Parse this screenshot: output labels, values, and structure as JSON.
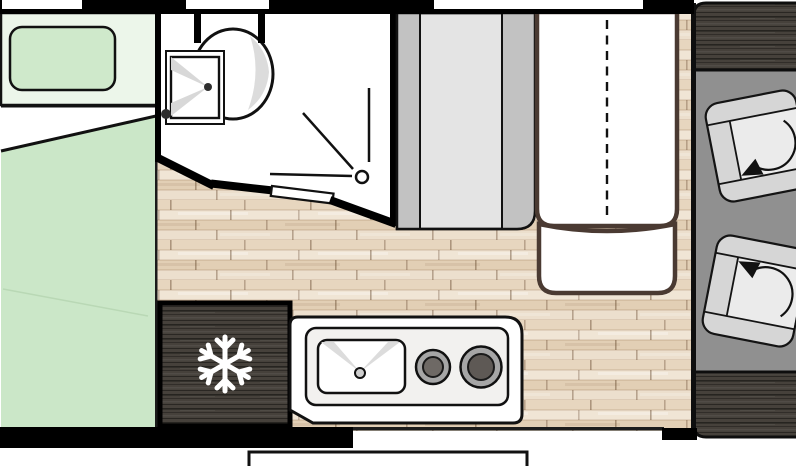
{
  "diagram": {
    "type": "motorhome-floor-plan",
    "orientation": "cab-on-right",
    "palette": {
      "wall": "#000000",
      "outside": "#ffffff",
      "wood_floor": "#ebddca",
      "cab_floor": "#909090",
      "dark_wood_furniture": "#46413b",
      "bed_green": "#cbe7c8",
      "bed_head_green": "#ecf6ea",
      "pillow_green": "#cfe9cb",
      "table_border_brown": "#4a3a32",
      "seat_gray": "#dcdcdc",
      "bench_stripe_light": "#e4e4e4",
      "bench_stripe_dark": "#c2c2c2",
      "burner_ring": "#a6a6a6",
      "burner_center_small": "#6e6965",
      "burner_center_large": "#5e5955",
      "bathroom_floor": "#ffffff"
    },
    "rooms": [
      {
        "name": "rear-bed-area",
        "furniture": [
          "double-bed",
          "bed-headboard",
          "pillow"
        ]
      },
      {
        "name": "bathroom",
        "furniture": [
          "toilet",
          "shower-tray",
          "sliding-door"
        ]
      },
      {
        "name": "dinette",
        "furniture": [
          "striped-bench-seat",
          "table-with-fold-line",
          "side-seat"
        ]
      },
      {
        "name": "kitchen",
        "furniture": [
          "refrigerator",
          "countertop",
          "sink",
          "two-burner-hob"
        ]
      },
      {
        "name": "cab",
        "furniture": [
          "cab-top-panel",
          "driver-swivel-seat",
          "passenger-swivel-seat",
          "cab-bottom-panel"
        ]
      }
    ],
    "icons": [
      {
        "name": "snowflake-icon",
        "meaning": "refrigerator-freezer"
      },
      {
        "name": "rotation-arrow-icon",
        "meaning": "swivel-seat-rotation"
      },
      {
        "name": "shower-spray-icon",
        "meaning": "shower"
      }
    ],
    "windows_count": 3,
    "entry": {
      "name": "entry-step-outside-door"
    }
  }
}
